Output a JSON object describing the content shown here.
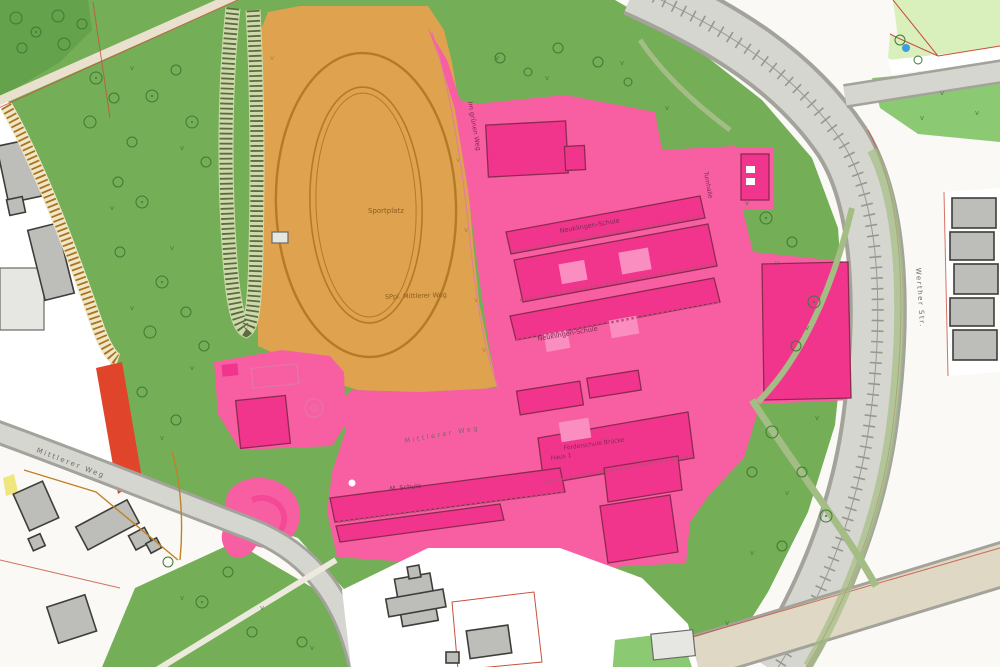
{
  "map": {
    "labels": {
      "sportplatz": "Sportplatz",
      "sportplatz_sub": "SPpl. Mittlerer Weg",
      "school_top": "Neuklingen-Schule",
      "school_mid": "Neuklingen-Schule",
      "school_foerder_line1": "Förderschule Brücke",
      "school_foerder_line2": "Haus 1",
      "school_m": "M. Schule",
      "turnhalle": "Turnhalle",
      "path_im_gruenen_weg": "Im grünen Weg",
      "street_mittlerer_weg_inner": "Mittlerer Weg",
      "street_mittlerer_weg": "Mittlerer Weg",
      "street_right": "Werther Str."
    },
    "colors": {
      "base": "#faf9f5",
      "park_green": "#74ae57",
      "park_green_dark": "#65a24c",
      "tree_stroke": "#3e7a33",
      "road_gray": "#d6d6d0",
      "road_edge": "#a3a39b",
      "road_beige": "#ded8c4",
      "green_path": "#a3bd85",
      "orange_field": "#dfa24e",
      "track_line": "#b47a28",
      "orange_text": "#8d5c1c",
      "pink_area": "#f85fa2",
      "magenta_building": "#f2358c",
      "building_outline": "#8c2a50",
      "pink_light": "#fa8ec0",
      "campus_text": "#7c2c50",
      "street_text": "#6d6d65",
      "gray_building": "#bdbdb9",
      "gray_building_outline": "#3d3d39",
      "white_parcel": "#ffffff",
      "parcel_red_line": "#c9503c",
      "light_green": "#d9f0bd",
      "bright_green": "#8cc973",
      "red_strip": "#e0452c",
      "yellow_strip": "#efe77d",
      "path_brown": "#c08226",
      "hatch_dark": "#5c6b44",
      "hatch_brown": "#a8741e",
      "water_blue": "#3a9fdc"
    }
  }
}
